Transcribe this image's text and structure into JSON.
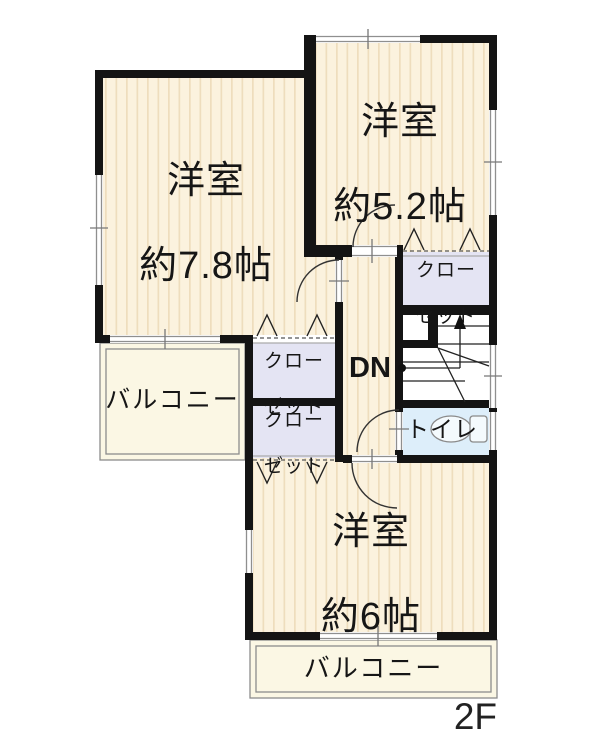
{
  "plan": {
    "floor_label": "2F",
    "rooms": {
      "room_78": {
        "line1": "洋室",
        "line2": "約7.8帖"
      },
      "room_52": {
        "line1": "洋室",
        "line2": "約5.2帖"
      },
      "room_6": {
        "line1": "洋室",
        "line2": "約6帖"
      }
    },
    "closet": {
      "line1": "クロー",
      "line2": "ゼット"
    },
    "balcony_label": "バルコニー",
    "toilet_label": "トイレ",
    "stairs_down_label": "DN",
    "colors": {
      "wall": "#141414",
      "floor": "#fbf2de",
      "floor_stripe": "#eeddbd",
      "closet_fill": "#e4e4f3",
      "toilet_fill": "#ddeefa",
      "balcony_fill": "#fbf7e4",
      "window_frame": "#8f8f8f"
    }
  }
}
